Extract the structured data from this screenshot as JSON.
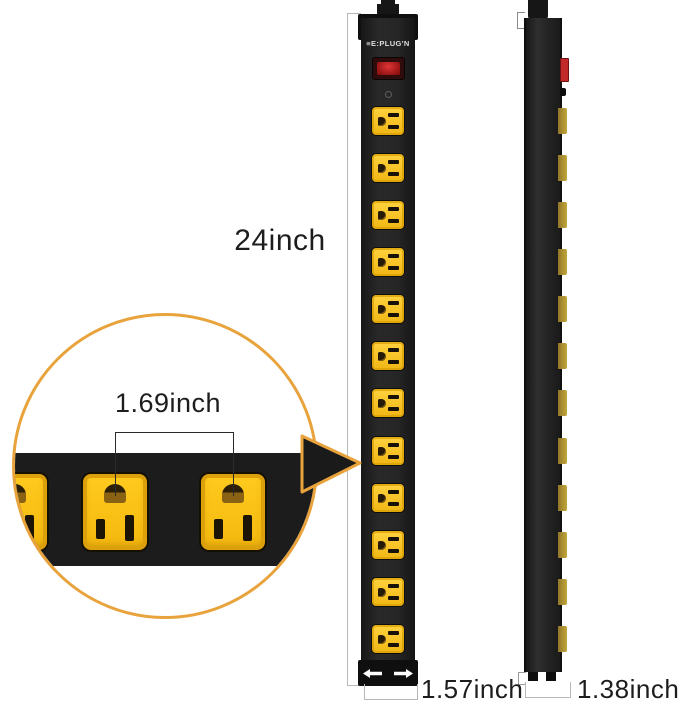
{
  "brand": {
    "logo_text": "E:PLUG'N",
    "mark": "≡"
  },
  "dimensions": {
    "height_label": "24inch",
    "outlet_spacing_label": "1.69inch",
    "width_label": "1.57inch",
    "depth_label": "1.38inch"
  },
  "outlets": {
    "front_count": 12,
    "side_count": 12,
    "callout_full_count": 2
  },
  "colors": {
    "outlet_yellow": "#f6c41c",
    "outlet_yellow_dark": "#d89f05",
    "strip_black": "#1f1f1f",
    "bracket_black": "#0f0f0f",
    "callout_orange": "#e8a33c",
    "switch_red": "#c22a2a",
    "dimension_line_gray": "#b8b8b8",
    "label_text": "#1d1d1d",
    "slot_dark": "#1c1405",
    "ground_brown": "#8a6214",
    "side_tab_gold": "#b99a30"
  }
}
